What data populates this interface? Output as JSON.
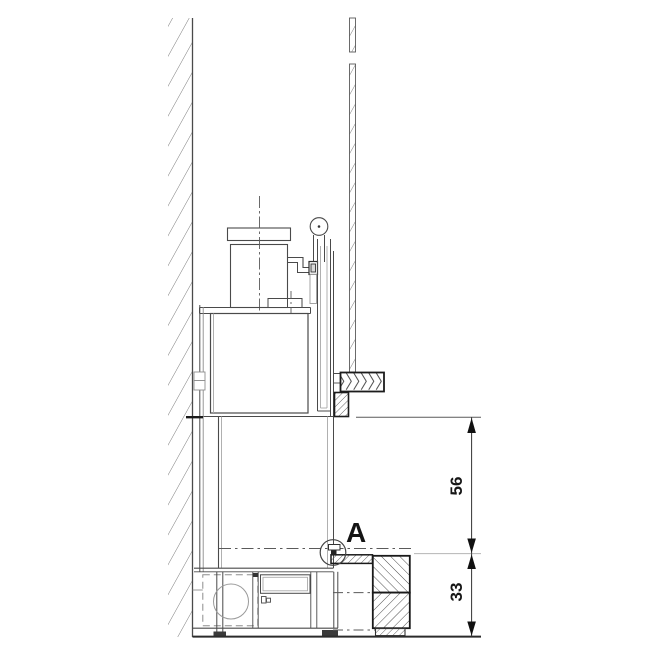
{
  "detail_marker": {
    "label": "A"
  },
  "dimensions": [
    {
      "id": "upper-clearance",
      "value": "56"
    },
    {
      "id": "lower-clearance",
      "value": "33"
    }
  ],
  "colors": {
    "background": "#ffffff",
    "line": "#4a4a4a",
    "line_dark": "#161616",
    "line_light": "#aaaaaa",
    "dimension_text": "#161616"
  }
}
